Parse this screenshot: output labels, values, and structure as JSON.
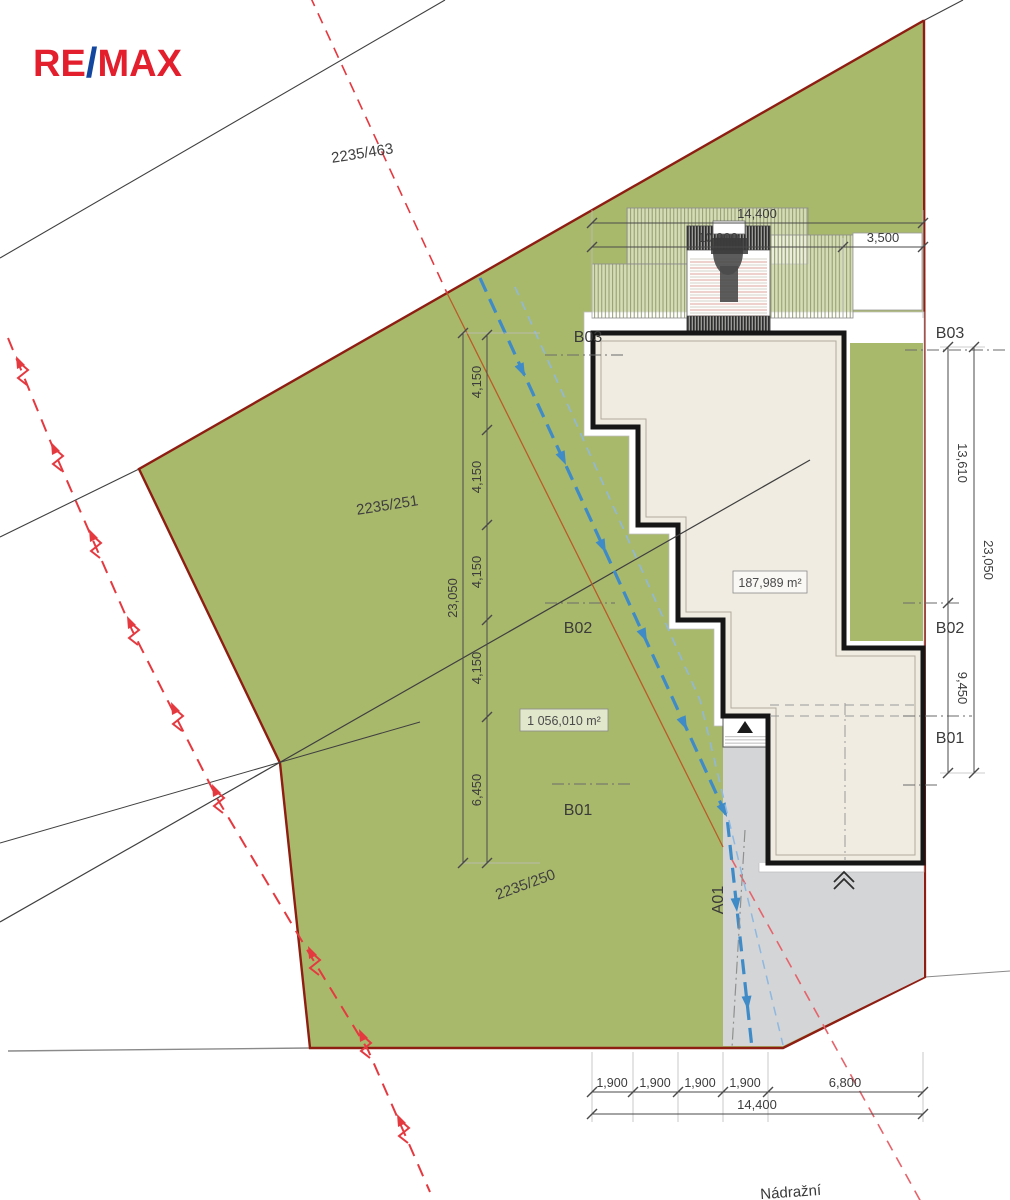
{
  "logo": {
    "re": "RE",
    "slash": "/",
    "max": "MAX"
  },
  "parcels": {
    "upper": "2235/463",
    "main": "2235/251",
    "lower": "2235/250"
  },
  "areas": {
    "building": "187,989 m²",
    "plot": "1 056,010 m²"
  },
  "markers": {
    "b01": "B01",
    "b02": "B02",
    "b03": "B03",
    "a01": "A01"
  },
  "street": "Nádražní",
  "dims": {
    "top": {
      "total": "14,400",
      "a": "10,900",
      "b": "3,500"
    },
    "left": {
      "total": "23,050",
      "a": "4,150",
      "b": "6,450"
    },
    "right": {
      "total": "23,050",
      "a": "13,610",
      "b": "9,450"
    },
    "bottom": {
      "total": "14,400",
      "a": "1,900",
      "b": "6,800"
    }
  },
  "colors": {
    "parcel_green": "#a9b96c",
    "boundary_red": "#8e1d12",
    "power_line_red": "#e53940",
    "flow_blue": "#3e8bc8",
    "driveway_gray": "#d3d5d7",
    "roof_beige": "#f0ece2"
  }
}
